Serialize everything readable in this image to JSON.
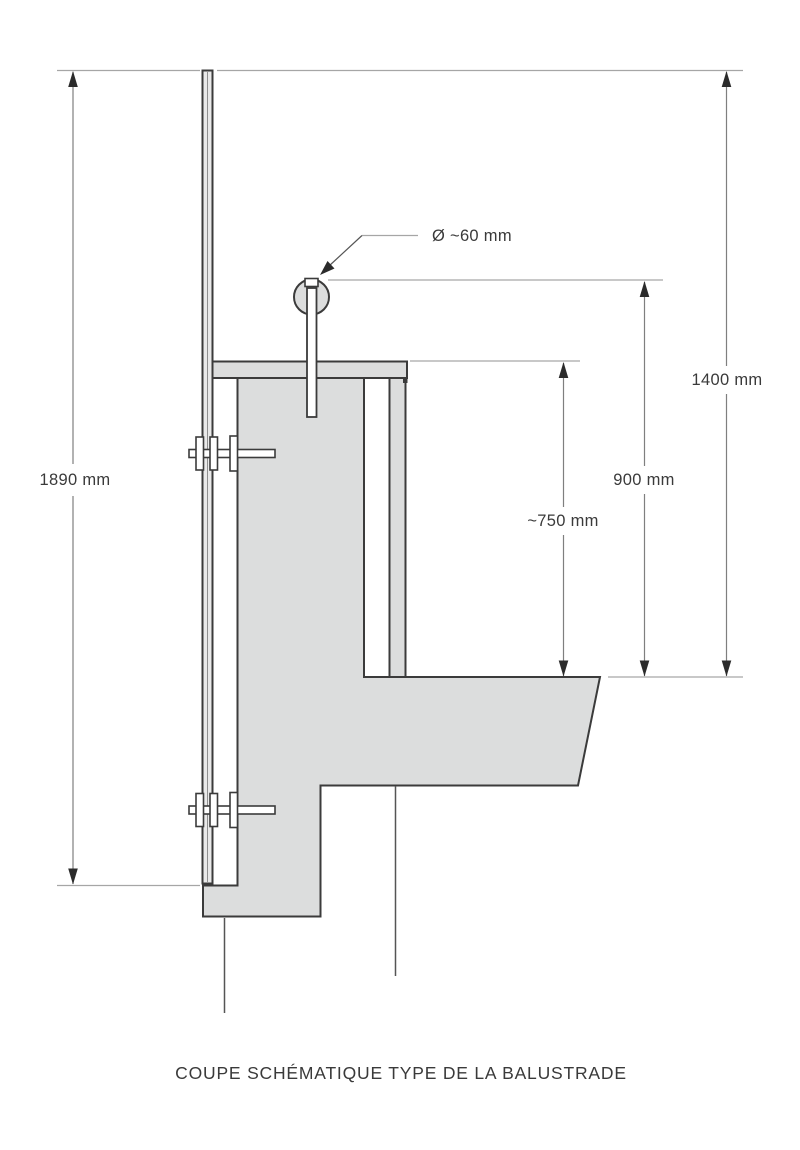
{
  "caption": "COUPE SCHÉMATIQUE TYPE DE LA BALUSTRADE",
  "dimensions": {
    "overall_height": {
      "label": "1890 mm"
    },
    "handrail_top_height": {
      "label": "1400 mm"
    },
    "floor_to_handrail_top": {
      "label": "900 mm"
    },
    "floor_to_coping_top": {
      "label": "~750 mm"
    },
    "handrail_diameter": {
      "label": "Ø ~60 mm"
    }
  },
  "colors": {
    "background": "#ffffff",
    "concrete_fill": "#dcdddd",
    "outline": "#3b3b3b",
    "dimension_line": "#7f7f7f",
    "extension_line": "#a6a6a6",
    "arrow": "#2b2b2b",
    "text": "#3a3a3a"
  }
}
